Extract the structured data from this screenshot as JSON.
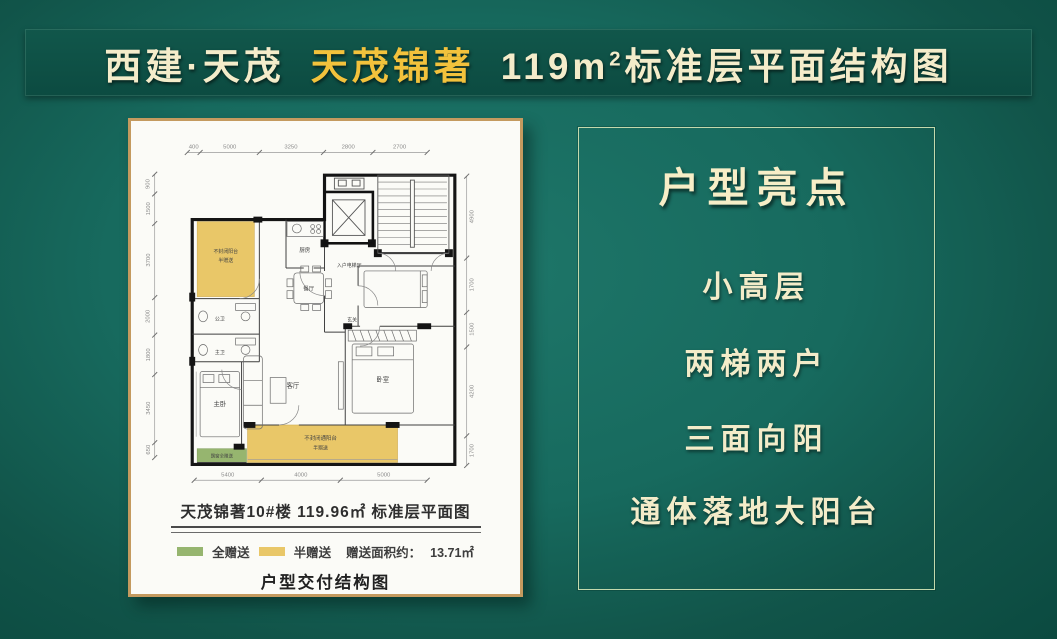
{
  "header": {
    "brand": "西建·天茂",
    "project": "天茂锦著",
    "area": "119m",
    "area_sup": "2",
    "suffix": "标准层平面结构图"
  },
  "highlights": {
    "title": "户型亮点",
    "items": [
      "小高层",
      "两梯两户",
      "三面向阳",
      "通体落地大阳台"
    ]
  },
  "plan_panel": {
    "title": "天茂锦著10#楼 119.96㎡ 标准层平面图",
    "legend": {
      "full_gift": "全赠送",
      "half_gift": "半赠送",
      "gift_area_label": "赠送面积约：",
      "gift_area_value": "13.71㎡"
    },
    "footer": "户型交付结构图",
    "colors": {
      "full_gift": "#96b56f",
      "half_gift": "#e9c768",
      "panel_border": "#c49a5f"
    }
  },
  "floor_plan": {
    "rooms": {
      "balcony_tl_l1": "不封闭阳台",
      "balcony_tl_l2": "半赠送",
      "kitchen": "厨房",
      "dining": "餐厅",
      "entry_hall": "入户电梯厅",
      "foyer": "玄关",
      "living": "客厅",
      "bedroom": "卧室",
      "master": "主卧",
      "bath_public": "公卫",
      "bath_master": "主卫",
      "balcony_b_l1": "不封闭通阳台",
      "balcony_b_l2": "半赠送",
      "bay_window": "飘窗全赠送"
    },
    "dims": {
      "top": [
        "400",
        "5000",
        "3250",
        "2800",
        "2700"
      ],
      "bottom": [
        "5400",
        "4000",
        "5000"
      ],
      "left": [
        "900",
        "1500",
        "3700",
        "2000",
        "1800",
        "3450",
        "650"
      ],
      "right": [
        "4900",
        "1700",
        "1500",
        "4200",
        "1700"
      ]
    }
  },
  "colors": {
    "background": "#176a5e",
    "banner": "#0d4f45",
    "cream": "#f4ecca",
    "gold": "#f2c23c"
  }
}
